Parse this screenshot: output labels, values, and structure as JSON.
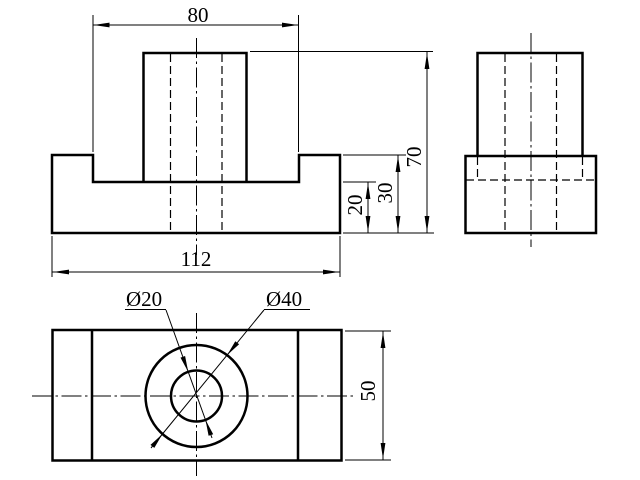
{
  "drawing": {
    "background": "#ffffff",
    "line_color": "#000000",
    "dimensions": {
      "slot_width": "80",
      "total_height": "70",
      "base_height": "30",
      "slot_floor_height": "20",
      "base_length": "112",
      "hole_diameter": "Ø20",
      "boss_diameter": "Ø40",
      "depth": "50"
    }
  }
}
